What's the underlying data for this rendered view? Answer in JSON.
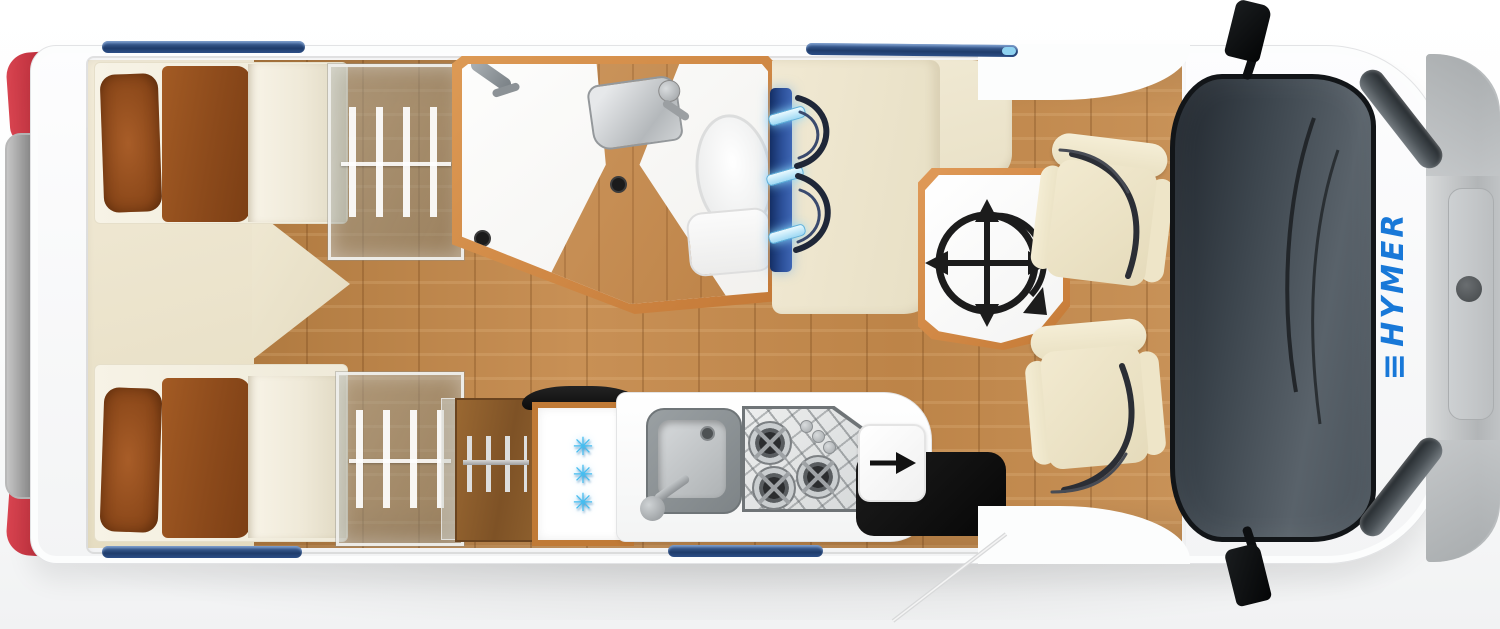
{
  "canvas": {
    "width": 1500,
    "height": 629
  },
  "brand": {
    "logo_prefix": "≡",
    "logo_text": "HYMER",
    "logo_color": "#1878D8"
  },
  "palette": {
    "body_white": "#FBFCFD",
    "front_bumper_gray": "#BDC0C2",
    "windshield_dark": "#3C444C",
    "taillight_red": "#C5303C",
    "roof_window_blue": "#2E4C7E",
    "floor_wood": "#C08B55",
    "furniture_wood_trim": "#CF8544",
    "upholstery_cream": "#F0E8D1",
    "bedding_brown": "#96511F",
    "snowflake_blue": "#45BDF0",
    "ambient_glow_blue": "#BFEAFF"
  },
  "layout": {
    "bedroom": {
      "beds": 2,
      "pillows_per_bed": 2,
      "wardrobes": 2
    },
    "bathroom": {
      "fixture_count": 3
    },
    "kitchen": {
      "fridge": {
        "glyph": "✳",
        "snowflake_count": 3
      },
      "stove": {
        "burner_count": 3,
        "knob_count": 3
      }
    },
    "dinette": {
      "seatbelt_count": 2,
      "glow_bar_count": 3
    },
    "cab": {
      "seat_count": 2,
      "mirror_count": 2,
      "headlight_count": 2
    },
    "roof_window_count": 4
  }
}
